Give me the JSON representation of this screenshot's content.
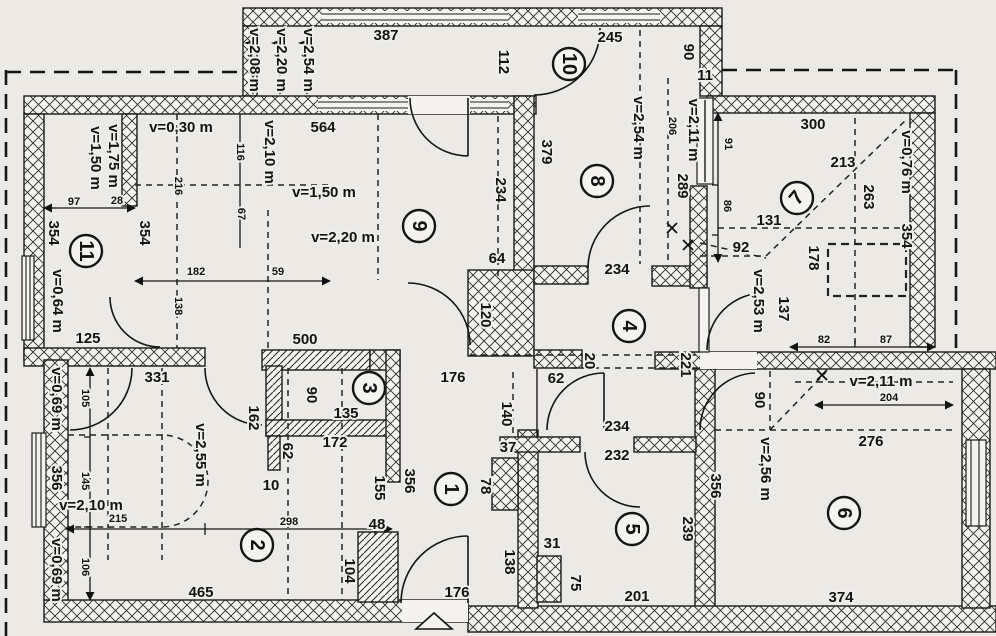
{
  "drawing": {
    "type": "floor-plan",
    "units_hint": "cm",
    "height_prefix": "v="
  },
  "rooms": [
    {
      "n": "1",
      "x": 451,
      "y": 489,
      "rot": 90
    },
    {
      "n": "2",
      "x": 257,
      "y": 545,
      "rot": 90
    },
    {
      "n": "3",
      "x": 369,
      "y": 388,
      "rot": 90
    },
    {
      "n": "4",
      "x": 629,
      "y": 326,
      "rot": 90
    },
    {
      "n": "5",
      "x": 632,
      "y": 529,
      "rot": 90
    },
    {
      "n": "6",
      "x": 844,
      "y": 513,
      "rot": 90
    },
    {
      "n": "7",
      "x": 797,
      "y": 198,
      "rot": -50
    },
    {
      "n": "8",
      "x": 597,
      "y": 181,
      "rot": 90
    },
    {
      "n": "9",
      "x": 419,
      "y": 226,
      "rot": 90
    },
    {
      "n": "10",
      "x": 569,
      "y": 64,
      "rot": 90
    },
    {
      "n": "11",
      "x": 86,
      "y": 251,
      "rot": 90
    }
  ],
  "labels": [
    {
      "t": "v=2,08 m",
      "x": 254,
      "y": 60,
      "r": 90
    },
    {
      "t": "v=2,20 m",
      "x": 281,
      "y": 60,
      "r": 90
    },
    {
      "t": "v=2,54 m",
      "x": 308,
      "y": 60,
      "r": 90
    },
    {
      "t": "387",
      "x": 386,
      "y": 36
    },
    {
      "t": "112",
      "x": 503,
      "y": 62,
      "r": 90
    },
    {
      "t": "245",
      "x": 610,
      "y": 38
    },
    {
      "t": "90",
      "x": 688,
      "y": 52,
      "r": 90
    },
    {
      "t": "11",
      "x": 705,
      "y": 76
    },
    {
      "t": "206",
      "x": 672,
      "y": 126,
      "r": 90,
      "s": 1
    },
    {
      "t": "v=2,11 m",
      "x": 693,
      "y": 130,
      "r": 90
    },
    {
      "t": "289",
      "x": 682,
      "y": 186,
      "r": 90
    },
    {
      "t": "v=2,54 m",
      "x": 638,
      "y": 128,
      "r": 90
    },
    {
      "t": "379",
      "x": 546,
      "y": 152,
      "r": 90
    },
    {
      "t": "234",
      "x": 500,
      "y": 190,
      "r": 90
    },
    {
      "t": "564",
      "x": 323,
      "y": 128
    },
    {
      "t": "v=0,30 m",
      "x": 181,
      "y": 128
    },
    {
      "t": "116",
      "x": 240,
      "y": 152,
      "r": 90,
      "s": 1
    },
    {
      "t": "v=2,10 m",
      "x": 269,
      "y": 152,
      "r": 90
    },
    {
      "t": "216",
      "x": 178,
      "y": 186,
      "r": 90,
      "s": 1
    },
    {
      "t": "67",
      "x": 241,
      "y": 214,
      "r": 90,
      "s": 1
    },
    {
      "t": "v=1,50 m",
      "x": 324,
      "y": 193
    },
    {
      "t": "v=2,20 m",
      "x": 343,
      "y": 238
    },
    {
      "t": "354",
      "x": 144,
      "y": 233,
      "r": 90
    },
    {
      "t": "182",
      "x": 196,
      "y": 272,
      "s": 1
    },
    {
      "t": "59",
      "x": 278,
      "y": 272,
      "s": 1
    },
    {
      "t": "v=1,75 m",
      "x": 113,
      "y": 156,
      "r": 90
    },
    {
      "t": "v=1,50 m",
      "x": 95,
      "y": 158,
      "r": 90
    },
    {
      "t": "97",
      "x": 74,
      "y": 202,
      "s": 1
    },
    {
      "t": "28",
      "x": 117,
      "y": 201,
      "s": 1
    },
    {
      "t": "354",
      "x": 53,
      "y": 233,
      "r": 90
    },
    {
      "t": "v=0,64 m",
      "x": 57,
      "y": 301,
      "r": 90
    },
    {
      "t": "125",
      "x": 88,
      "y": 339
    },
    {
      "t": "138",
      "x": 178,
      "y": 306,
      "r": 90,
      "s": 1
    },
    {
      "t": "500",
      "x": 305,
      "y": 340
    },
    {
      "t": "300",
      "x": 813,
      "y": 125
    },
    {
      "t": "91",
      "x": 728,
      "y": 144,
      "r": 90,
      "s": 1
    },
    {
      "t": "213",
      "x": 843,
      "y": 163
    },
    {
      "t": "v=0,76 m",
      "x": 906,
      "y": 162,
      "r": 90
    },
    {
      "t": "263",
      "x": 868,
      "y": 197,
      "r": 90
    },
    {
      "t": "86",
      "x": 727,
      "y": 206,
      "r": 90,
      "s": 1
    },
    {
      "t": "131",
      "x": 769,
      "y": 221
    },
    {
      "t": "92",
      "x": 741,
      "y": 248
    },
    {
      "t": "178",
      "x": 813,
      "y": 258,
      "r": 90
    },
    {
      "t": "354",
      "x": 906,
      "y": 236,
      "r": 90
    },
    {
      "t": "v=2,53 m",
      "x": 758,
      "y": 301,
      "r": 90
    },
    {
      "t": "137",
      "x": 783,
      "y": 309,
      "r": 90
    },
    {
      "t": "82",
      "x": 824,
      "y": 340,
      "s": 1
    },
    {
      "t": "87",
      "x": 886,
      "y": 340,
      "s": 1
    },
    {
      "t": "64",
      "x": 497,
      "y": 259
    },
    {
      "t": "120",
      "x": 485,
      "y": 315,
      "r": 90
    },
    {
      "t": "234",
      "x": 617,
      "y": 270
    },
    {
      "t": "20",
      "x": 589,
      "y": 361,
      "r": 90
    },
    {
      "t": "221",
      "x": 685,
      "y": 365,
      "r": 90
    },
    {
      "t": "176",
      "x": 453,
      "y": 378
    },
    {
      "t": "62",
      "x": 556,
      "y": 379
    },
    {
      "t": "v=2,11 m",
      "x": 881,
      "y": 382
    },
    {
      "t": "204",
      "x": 889,
      "y": 398,
      "s": 1
    },
    {
      "t": "90",
      "x": 759,
      "y": 400,
      "r": 90
    },
    {
      "t": "276",
      "x": 871,
      "y": 442
    },
    {
      "t": "v=2,56 m",
      "x": 765,
      "y": 469,
      "r": 90
    },
    {
      "t": "356",
      "x": 715,
      "y": 486,
      "r": 90
    },
    {
      "t": "374",
      "x": 841,
      "y": 598
    },
    {
      "t": "331",
      "x": 157,
      "y": 378
    },
    {
      "t": "v=0,69 m",
      "x": 56,
      "y": 399,
      "r": 90
    },
    {
      "t": "105",
      "x": 85,
      "y": 398,
      "r": 90,
      "s": 1
    },
    {
      "t": "v=2,55 m",
      "x": 200,
      "y": 455,
      "r": 90
    },
    {
      "t": "356",
      "x": 56,
      "y": 478,
      "r": 90
    },
    {
      "t": "145",
      "x": 85,
      "y": 481,
      "r": 90,
      "s": 1
    },
    {
      "t": "v=2,10 m",
      "x": 91,
      "y": 506
    },
    {
      "t": "215",
      "x": 118,
      "y": 519,
      "s": 1
    },
    {
      "t": "v=0,69 m",
      "x": 56,
      "y": 570,
      "r": 90
    },
    {
      "t": "106",
      "x": 85,
      "y": 567,
      "r": 90,
      "s": 1
    },
    {
      "t": "465",
      "x": 201,
      "y": 593
    },
    {
      "t": "162",
      "x": 253,
      "y": 418,
      "r": 90
    },
    {
      "t": "90",
      "x": 311,
      "y": 395,
      "r": 90
    },
    {
      "t": "135",
      "x": 346,
      "y": 414
    },
    {
      "t": "172",
      "x": 335,
      "y": 443
    },
    {
      "t": "62",
      "x": 287,
      "y": 451,
      "r": 90
    },
    {
      "t": "10",
      "x": 271,
      "y": 486
    },
    {
      "t": "155",
      "x": 379,
      "y": 488,
      "r": 90
    },
    {
      "t": "356",
      "x": 409,
      "y": 481,
      "r": 90
    },
    {
      "t": "298",
      "x": 289,
      "y": 522,
      "s": 1
    },
    {
      "t": "48",
      "x": 377,
      "y": 525
    },
    {
      "t": "104",
      "x": 349,
      "y": 571,
      "r": 90
    },
    {
      "t": "176",
      "x": 457,
      "y": 593
    },
    {
      "t": "140",
      "x": 506,
      "y": 414,
      "r": 90
    },
    {
      "t": "234",
      "x": 617,
      "y": 427
    },
    {
      "t": "37",
      "x": 508,
      "y": 448
    },
    {
      "t": "232",
      "x": 617,
      "y": 456
    },
    {
      "t": "78",
      "x": 485,
      "y": 486,
      "r": 90
    },
    {
      "t": "138",
      "x": 509,
      "y": 562,
      "r": 90
    },
    {
      "t": "31",
      "x": 552,
      "y": 544
    },
    {
      "t": "75",
      "x": 575,
      "y": 583,
      "r": 90
    },
    {
      "t": "201",
      "x": 637,
      "y": 597
    },
    {
      "t": "239",
      "x": 687,
      "y": 529,
      "r": 90
    }
  ]
}
